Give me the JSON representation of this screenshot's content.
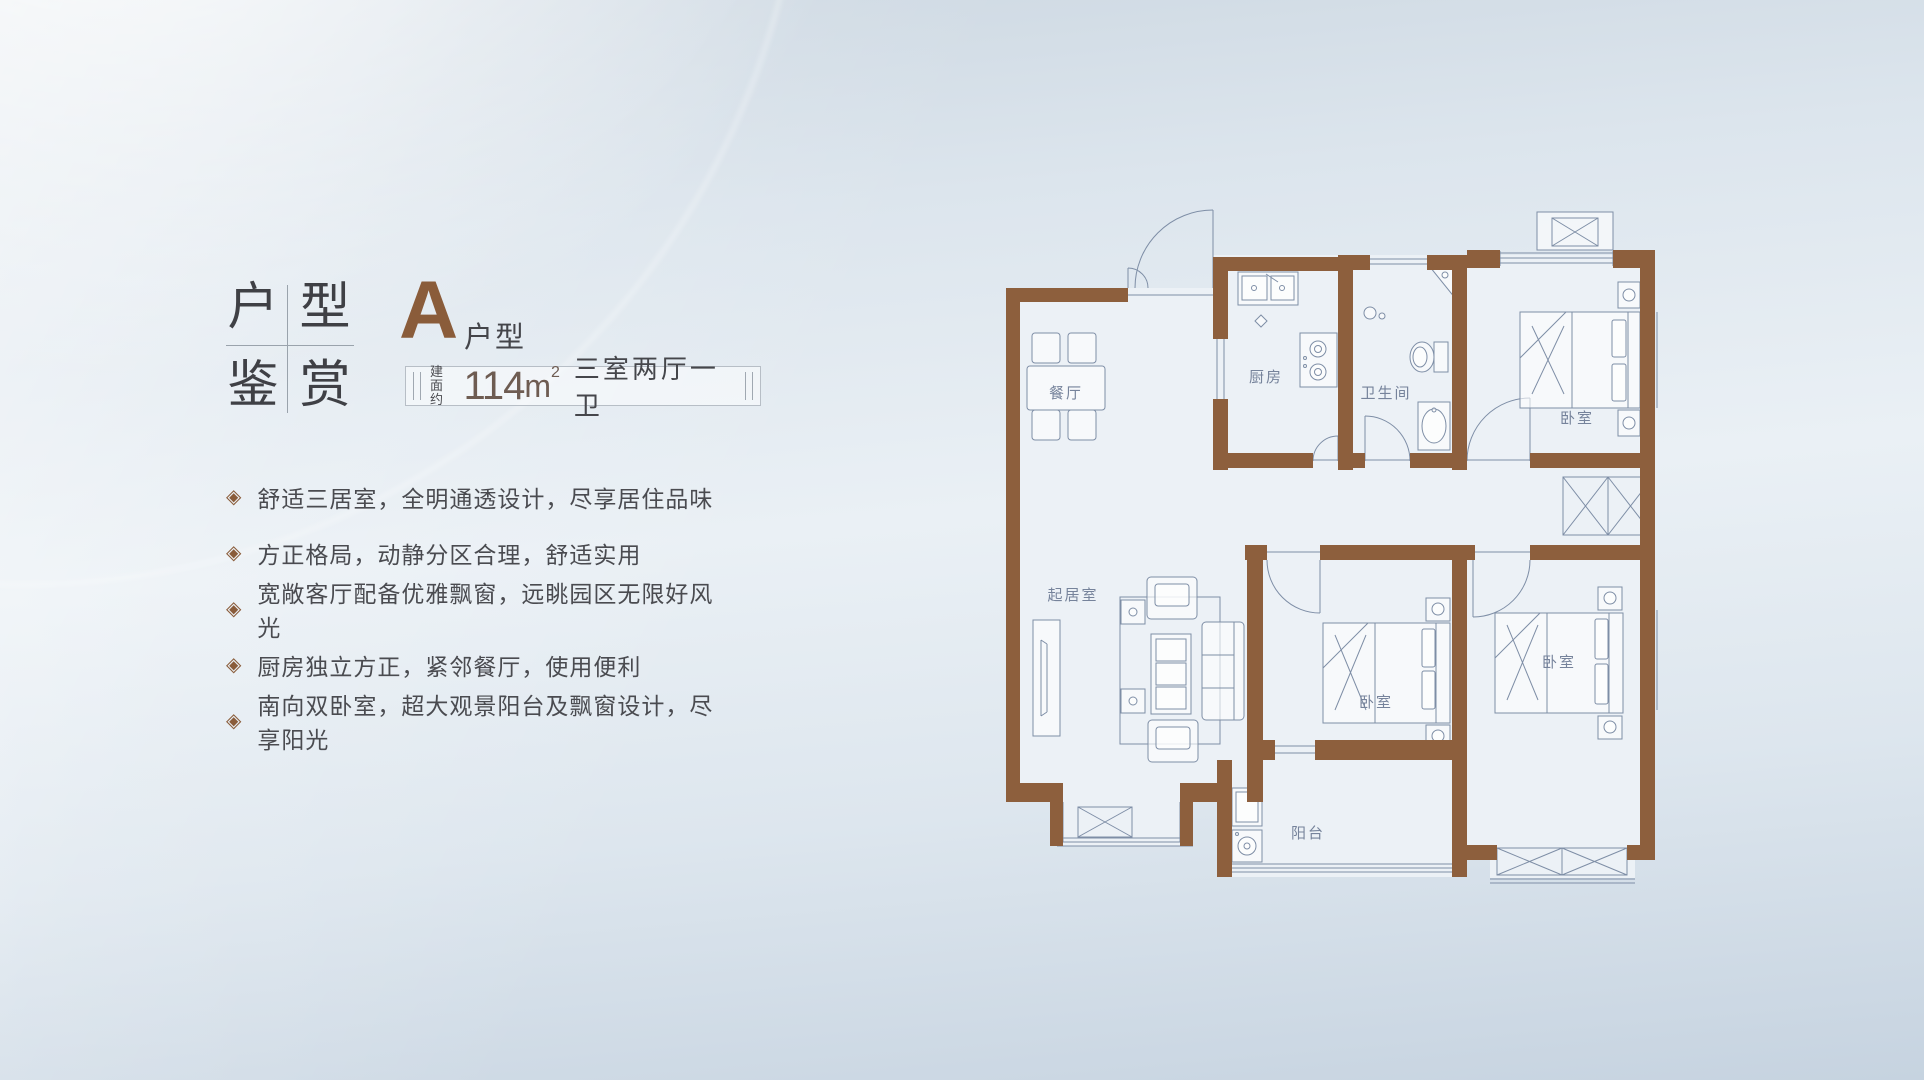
{
  "unit_card": {
    "title_chars": [
      "户",
      "型",
      "鉴",
      "赏"
    ],
    "unit_letter": "A",
    "unit_suffix": "户型",
    "area_label_line1": "建",
    "area_label_line2": "面约",
    "area_value": "114",
    "area_unit": "m",
    "area_superscript": "2",
    "layout_summary": "三室两厅一卫"
  },
  "features": {
    "bullet_icon": "◈",
    "items": [
      "舒适三居室，全明通透设计，尽享居住品味",
      "方正格局，动静分区合理，舒适实用",
      "宽敞客厅配备优雅飘窗，远眺园区无限好风光",
      "厨房独立方正，紧邻餐厅，使用便利",
      "南向双卧室，超大观景阳台及飘窗设计，尽享阳光"
    ]
  },
  "floorplan": {
    "labels": {
      "dining": "餐厅",
      "kitchen": "厨房",
      "bathroom": "卫生间",
      "bedroom_north": "卧室",
      "living": "起居室",
      "bedroom_middle": "卧室",
      "bedroom_south": "卧室",
      "balcony": "阳台"
    }
  },
  "colors": {
    "wall": "#8D5F3D",
    "plan_line": "#7E8EA6",
    "accent_brown": "#8A5C3A",
    "text_dark": "#45464B",
    "room_label": "#76839B"
  }
}
